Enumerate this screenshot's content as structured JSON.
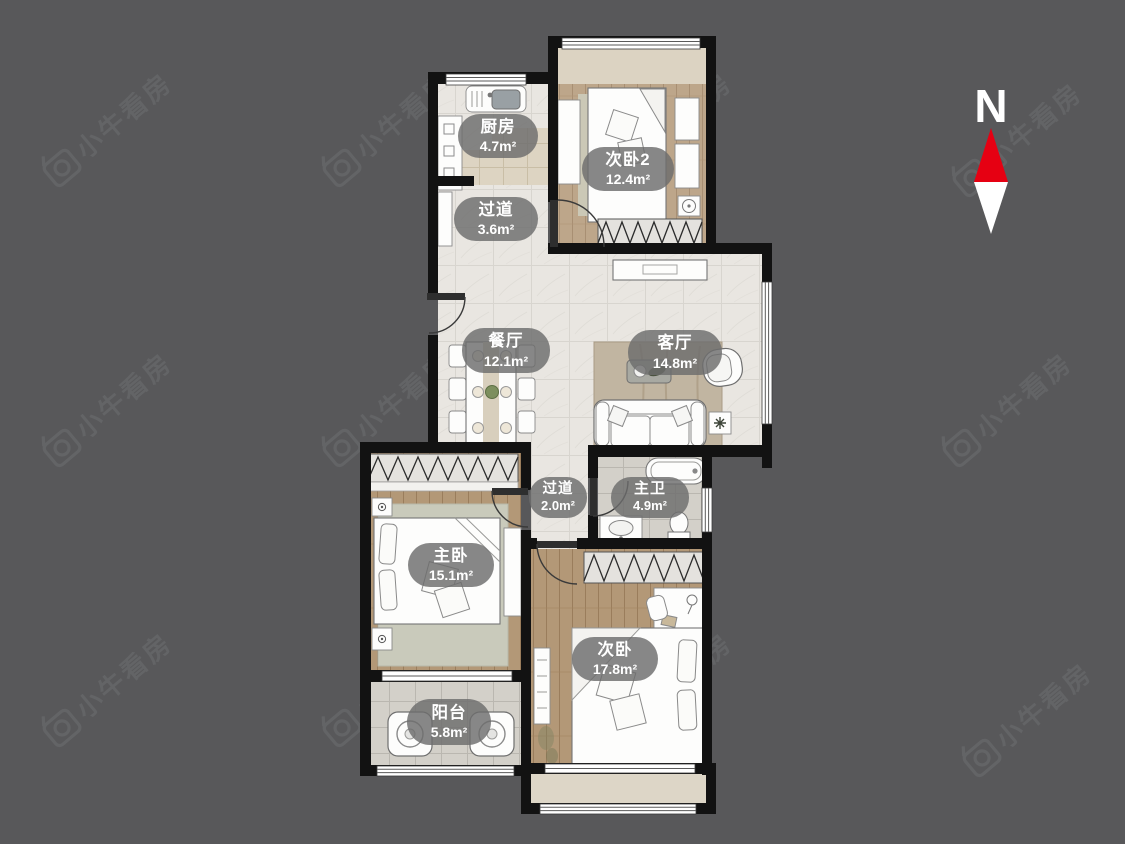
{
  "colors": {
    "background": "#58585a",
    "wall": "#121212",
    "compass_red": "#e60012",
    "label_bubble": "#6c6c6c",
    "label_text": "#ffffff",
    "watermark": "#6e7072"
  },
  "watermark": {
    "text": "小牛看房"
  },
  "compass": {
    "north_label": "N"
  },
  "rooms": [
    {
      "id": "kitchen",
      "name": "厨房",
      "area": "4.7m²"
    },
    {
      "id": "bedroom2",
      "name": "次卧2",
      "area": "12.4m²"
    },
    {
      "id": "hallway-north",
      "name": "过道",
      "area": "3.6m²"
    },
    {
      "id": "dining",
      "name": "餐厅",
      "area": "12.1m²"
    },
    {
      "id": "living",
      "name": "客厅",
      "area": "14.8m²"
    },
    {
      "id": "hallway-south",
      "name": "过道",
      "area": "2.0m²"
    },
    {
      "id": "master-bath",
      "name": "主卫",
      "area": "4.9m²"
    },
    {
      "id": "master-bedroom",
      "name": "主卧",
      "area": "15.1m²"
    },
    {
      "id": "bedroom",
      "name": "次卧",
      "area": "17.8m²"
    },
    {
      "id": "balcony",
      "name": "阳台",
      "area": "5.8m²"
    }
  ]
}
